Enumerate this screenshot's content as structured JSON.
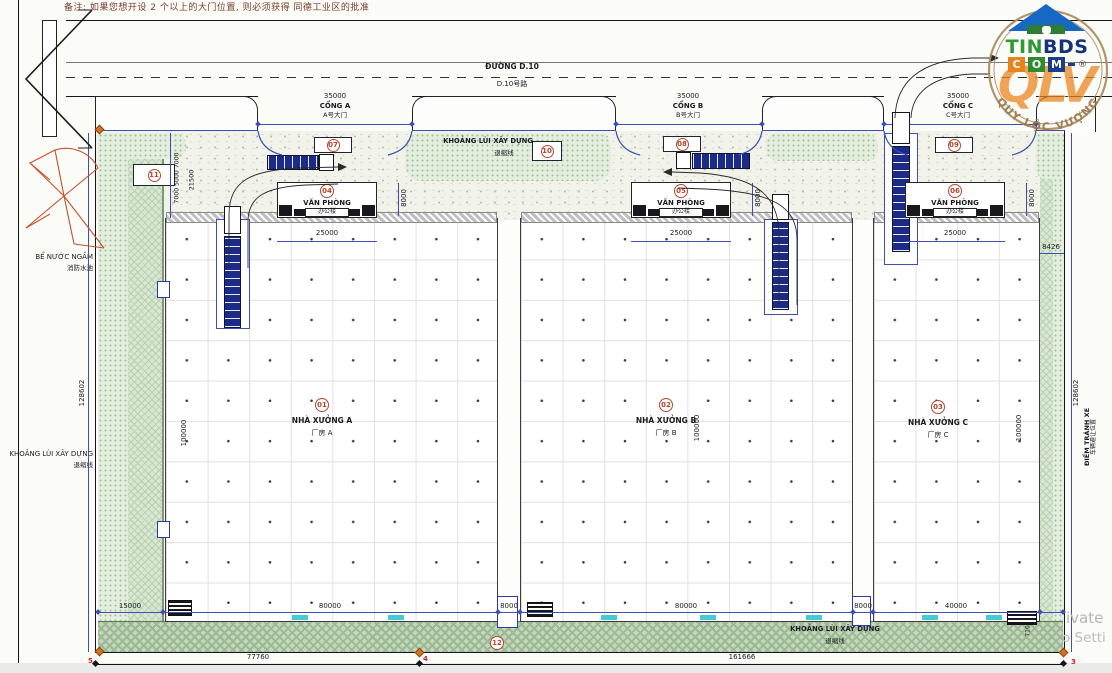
{
  "note": "备注: 如果您想开设 2 个以上的大门位置, 则必须获得 同德工业区的批准",
  "road": {
    "name_vi": "ĐƯỜNG D.10",
    "name_cn": "D.10号路"
  },
  "gates": [
    {
      "dim": "35000",
      "name_vi": "CỔNG A",
      "name_cn": "A号大门",
      "callout": "07"
    },
    {
      "dim": "35000",
      "name_vi": "CỔNG B",
      "name_cn": "B号大门",
      "callout": "08"
    },
    {
      "dim": "35000",
      "name_vi": "CỔNG C",
      "name_cn": "C号大门",
      "callout": "09"
    }
  ],
  "offices": [
    {
      "callout": "04",
      "name_vi": "VĂN PHÒNG",
      "name_cn": "办公楼",
      "width": "25000",
      "depth": "8000"
    },
    {
      "callout": "05",
      "name_vi": "VĂN PHÒNG",
      "name_cn": "办公楼",
      "width": "25000",
      "depth": "8000"
    },
    {
      "callout": "06",
      "name_vi": "VĂN PHÒNG",
      "name_cn": "办公楼",
      "width": "25000",
      "depth": "8000"
    }
  ],
  "factories": [
    {
      "callout": "01",
      "name_vi": "NHÀ XƯỞNG A",
      "name_cn": "厂房 A",
      "length": "100000"
    },
    {
      "callout": "02",
      "name_vi": "NHÀ XƯỞNG B",
      "name_cn": "厂房 B",
      "length": "100000"
    },
    {
      "callout": "03",
      "name_vi": "NHÀ XƯỞNG C",
      "name_cn": "厂房 C",
      "length": "100000"
    }
  ],
  "setback_top": {
    "label_vi": "KHOẢNG LÙI XÂY DỰNG",
    "label_cn": "退缩线",
    "callout": "10"
  },
  "setback_bottom": {
    "label_vi": "KHOẢNG LÙI XÂY DỰNG",
    "label_cn": "退缩线",
    "callout": "12"
  },
  "left_side": {
    "water_vi": "BỂ NƯỚC NGẦM",
    "water_cn": "消防水池",
    "setback_vi": "KHOẢNG LÙI XÂY DỰNG",
    "setback_cn": "退缩线",
    "height_dim": "128602",
    "callout": "11"
  },
  "right_side": {
    "height_dim": "128602",
    "avoid_vi": "ĐIỂM TRÁNH XE",
    "avoid_cn": "车辆避让位置",
    "gap_dim": "8426",
    "corner_dim": "7102"
  },
  "dims": {
    "stack_left": "7000 5000 7000",
    "total_left_top": "21500",
    "bottom_row": [
      "15000",
      "80000",
      "8000",
      "80000",
      "8000",
      "40000"
    ],
    "bottom_total_a": "77760",
    "bottom_total_b": "161666"
  },
  "markers": {
    "m5": "5",
    "m4": "4",
    "m3": "3"
  },
  "logo": {
    "brand_a": "TIN",
    "brand_b": "BDS",
    "letters": [
      "C",
      "O",
      "M"
    ],
    "reg": "®",
    "stamp_text": "QUY LỘC VƯỢNG",
    "monogram": "QLV"
  },
  "watermark": {
    "line1": "ivate",
    "line2": "o Setti"
  },
  "colors": {
    "accent_blue": "#3d4fb5",
    "callout_red": "#b5462e",
    "green_light": "#e4eede",
    "green_dark": "#c3d7bc",
    "logo_orange": "#e8831c",
    "logo_green": "#2e8b2e",
    "logo_navy": "#1a3e8c"
  }
}
